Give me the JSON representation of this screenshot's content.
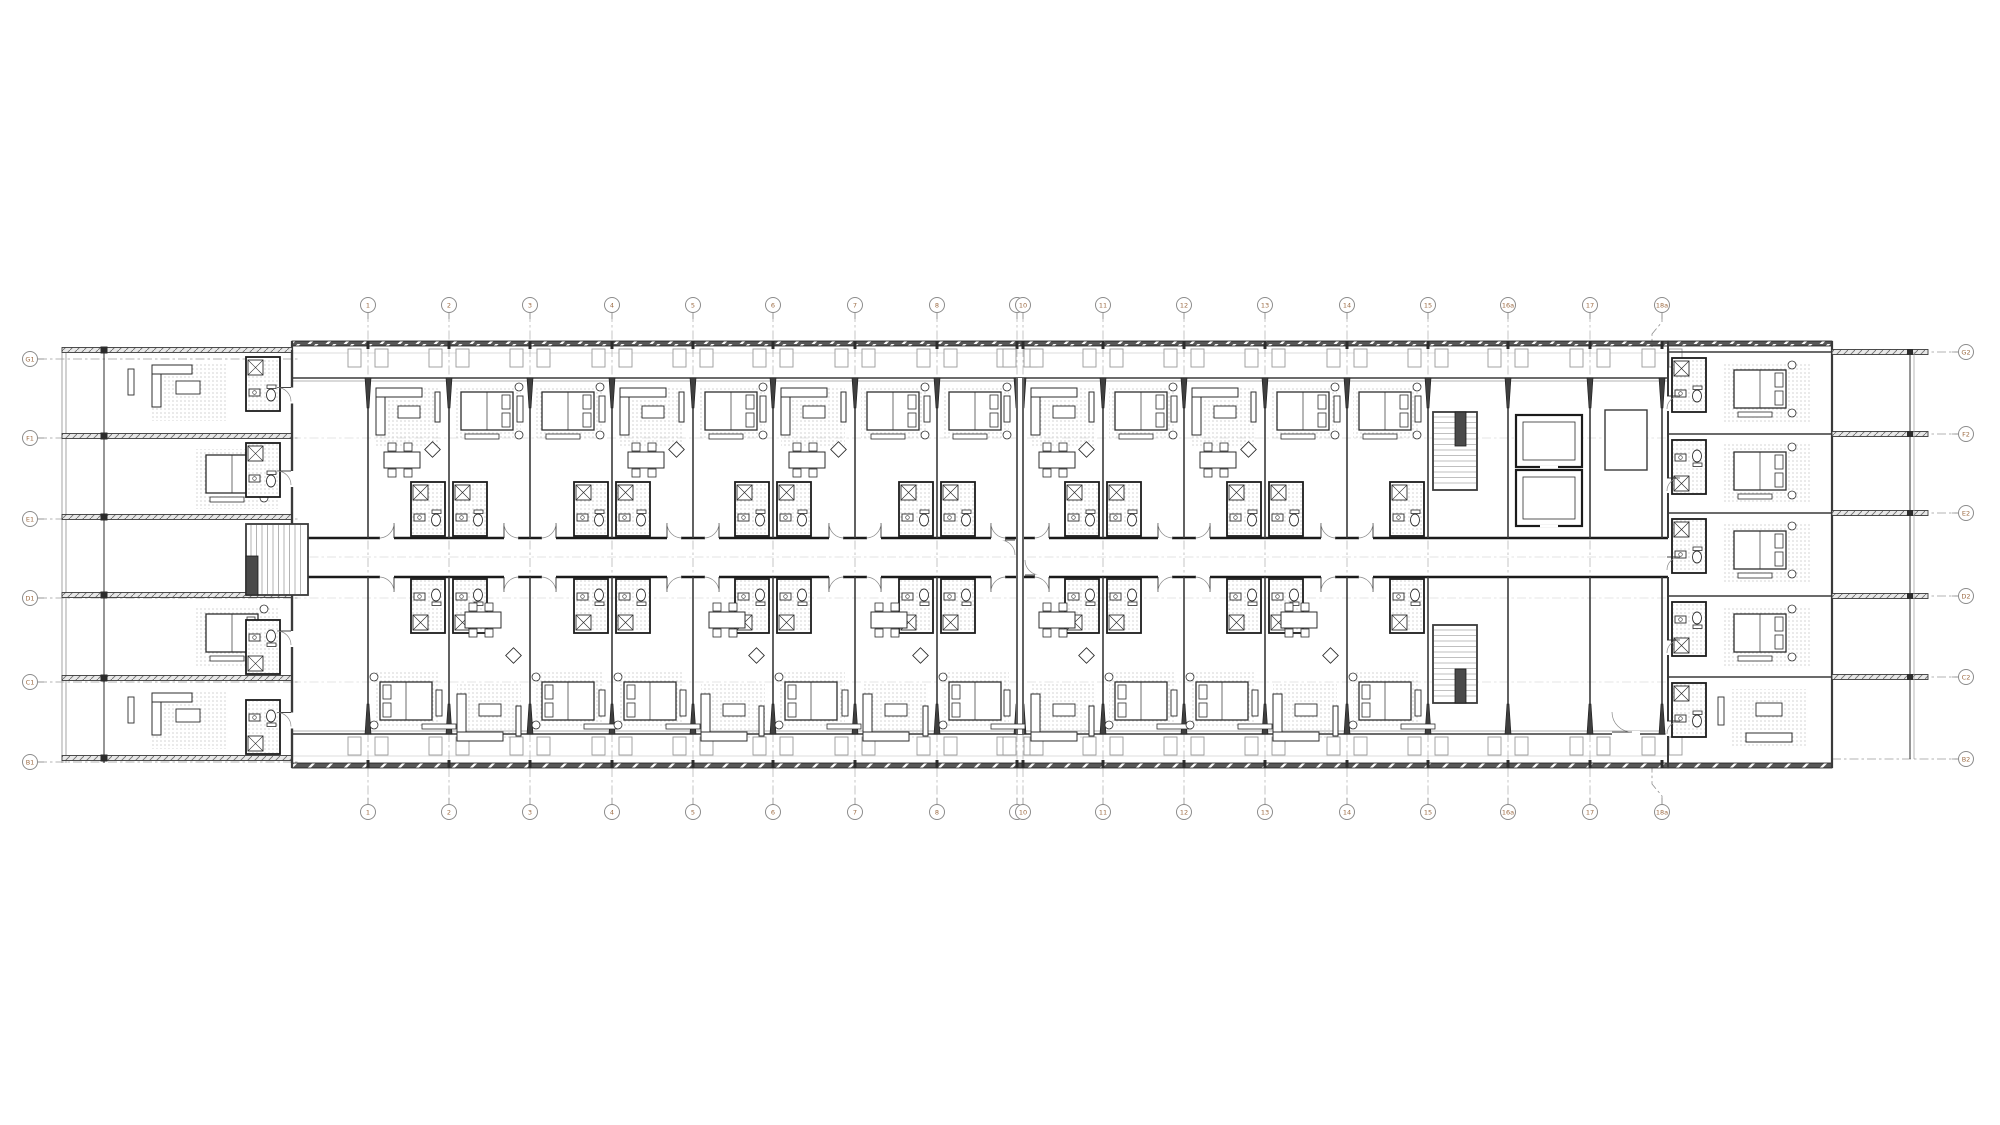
{
  "meta": {
    "drawing_type": "architectural-floor-plan",
    "description": "Typical hotel floor plan: long slab building with central corridor, repeating guestroom modules with bathroom pods, balcony bands top and bottom, west wing with stair, east wing with rooms and terrace fins, stair and elevator core near east end"
  },
  "canvas": {
    "w": 2000,
    "h": 1125,
    "bg": "#ffffff"
  },
  "colors": {
    "line": "#2e2e2e",
    "wall": "#3a3a3a",
    "dark": "#1b1b1b",
    "light": "#9a9a9a",
    "faint": "#bdbdbd",
    "gridline": "#8f8f8f",
    "bubble_stroke": "#8c8c8c",
    "bubble_text": "#9c6b43",
    "stipple": "#9a9a9a",
    "band": "#575757",
    "white": "#ffffff"
  },
  "grid": {
    "top": {
      "y": 305,
      "leader_end": 341,
      "bubbles": [
        {
          "label": "1",
          "x": 368
        },
        {
          "label": "2",
          "x": 449
        },
        {
          "label": "3",
          "x": 530
        },
        {
          "label": "4",
          "x": 612
        },
        {
          "label": "5",
          "x": 693
        },
        {
          "label": "6",
          "x": 773
        },
        {
          "label": "7",
          "x": 855
        },
        {
          "label": "8",
          "x": 937
        },
        {
          "label": "9",
          "x": 1017
        },
        {
          "label": "10",
          "x": 1023
        },
        {
          "label": "11",
          "x": 1103
        },
        {
          "label": "12",
          "x": 1184
        },
        {
          "label": "13",
          "x": 1265
        },
        {
          "label": "14",
          "x": 1347
        },
        {
          "label": "15",
          "x": 1428
        },
        {
          "label": "16a",
          "x": 1508
        },
        {
          "label": "17",
          "x": 1590
        },
        {
          "label": "18a",
          "x": 1662,
          "jog": 14
        }
      ]
    },
    "bottom": {
      "y": 812,
      "leader_end": 768,
      "bubbles": [
        {
          "label": "1",
          "x": 368
        },
        {
          "label": "2",
          "x": 449
        },
        {
          "label": "3",
          "x": 530
        },
        {
          "label": "4",
          "x": 612
        },
        {
          "label": "5",
          "x": 693
        },
        {
          "label": "6",
          "x": 773
        },
        {
          "label": "7",
          "x": 855
        },
        {
          "label": "8",
          "x": 937
        },
        {
          "label": "9",
          "x": 1017
        },
        {
          "label": "10",
          "x": 1023
        },
        {
          "label": "11",
          "x": 1103
        },
        {
          "label": "12",
          "x": 1184
        },
        {
          "label": "13",
          "x": 1265
        },
        {
          "label": "14",
          "x": 1347
        },
        {
          "label": "15",
          "x": 1428
        },
        {
          "label": "16a",
          "x": 1508
        },
        {
          "label": "17",
          "x": 1590
        },
        {
          "label": "18a",
          "x": 1662,
          "jog": 14
        }
      ]
    },
    "left": {
      "x": 30,
      "bubbles": [
        {
          "label": "G1",
          "y": 359
        },
        {
          "label": "F1",
          "y": 438
        },
        {
          "label": "E1",
          "y": 519
        },
        {
          "label": "D1",
          "y": 598
        },
        {
          "label": "C1",
          "y": 682
        },
        {
          "label": "B1",
          "y": 762
        }
      ]
    },
    "right": {
      "x": 1966,
      "bubbles": [
        {
          "label": "G2",
          "y": 352
        },
        {
          "label": "F2",
          "y": 434
        },
        {
          "label": "E2",
          "y": 513
        },
        {
          "label": "D2",
          "y": 596
        },
        {
          "label": "C2",
          "y": 677
        },
        {
          "label": "B2",
          "y": 759
        }
      ]
    }
  },
  "building": {
    "bar": {
      "x1": 292,
      "x2": 1668,
      "top_edge": 341,
      "face_top": 378,
      "pod_top": 482,
      "corr_top": 538,
      "corr_mid": 557,
      "corr_bot": 577,
      "pod_bot_end": 633,
      "face_bot": 734,
      "bot_edge": 763,
      "joint": [
        1017,
        1023
      ]
    },
    "bays_top": [
      {
        "x1": 292,
        "x2": 368,
        "type": "terrace"
      },
      {
        "x1": 368,
        "x2": 449,
        "type": "living"
      },
      {
        "x1": 449,
        "x2": 530,
        "type": "bed"
      },
      {
        "x1": 530,
        "x2": 612,
        "type": "bed"
      },
      {
        "x1": 612,
        "x2": 693,
        "type": "living"
      },
      {
        "x1": 693,
        "x2": 773,
        "type": "bed"
      },
      {
        "x1": 773,
        "x2": 855,
        "type": "living"
      },
      {
        "x1": 855,
        "x2": 937,
        "type": "bed"
      },
      {
        "x1": 937,
        "x2": 1017,
        "type": "bed"
      },
      {
        "x1": 1023,
        "x2": 1103,
        "type": "living"
      },
      {
        "x1": 1103,
        "x2": 1184,
        "type": "bed"
      },
      {
        "x1": 1184,
        "x2": 1265,
        "type": "living"
      },
      {
        "x1": 1265,
        "x2": 1347,
        "type": "bed"
      },
      {
        "x1": 1347,
        "x2": 1428,
        "type": "bed"
      },
      {
        "x1": 1428,
        "x2": 1508,
        "type": "stair"
      },
      {
        "x1": 1508,
        "x2": 1590,
        "type": "elevator"
      },
      {
        "x1": 1590,
        "x2": 1662,
        "type": "lobby"
      }
    ],
    "bays_bottom": [
      {
        "x1": 292,
        "x2": 368,
        "type": "terrace"
      },
      {
        "x1": 368,
        "x2": 449,
        "type": "bed"
      },
      {
        "x1": 449,
        "x2": 530,
        "type": "living"
      },
      {
        "x1": 530,
        "x2": 612,
        "type": "bed"
      },
      {
        "x1": 612,
        "x2": 693,
        "type": "bed"
      },
      {
        "x1": 693,
        "x2": 773,
        "type": "living"
      },
      {
        "x1": 773,
        "x2": 855,
        "type": "bed"
      },
      {
        "x1": 855,
        "x2": 937,
        "type": "living"
      },
      {
        "x1": 937,
        "x2": 1017,
        "type": "bed"
      },
      {
        "x1": 1023,
        "x2": 1103,
        "type": "living"
      },
      {
        "x1": 1103,
        "x2": 1184,
        "type": "bed"
      },
      {
        "x1": 1184,
        "x2": 1265,
        "type": "bed"
      },
      {
        "x1": 1265,
        "x2": 1347,
        "type": "living"
      },
      {
        "x1": 1347,
        "x2": 1428,
        "type": "bed"
      },
      {
        "x1": 1428,
        "x2": 1508,
        "type": "stair"
      },
      {
        "x1": 1508,
        "x2": 1590,
        "type": "lobby"
      },
      {
        "x1": 1590,
        "x2": 1662,
        "type": "lobby"
      }
    ],
    "left_wing": {
      "edge_x1": 62,
      "edge_x2": 66,
      "colonnade_x": 104,
      "room_x1": 110,
      "x2": 292,
      "top": 350,
      "bottom": 763,
      "walls_y": [
        350,
        436,
        517,
        595,
        678,
        758
      ],
      "rooms": [
        {
          "y1": 355,
          "y2": 436,
          "type": "living"
        },
        {
          "y1": 441,
          "y2": 517,
          "type": "bed"
        },
        {
          "y1": 522,
          "y2": 595,
          "type": "stair"
        },
        {
          "y1": 600,
          "y2": 678,
          "type": "bed"
        },
        {
          "y1": 683,
          "y2": 758,
          "type": "living"
        }
      ]
    },
    "right_wing": {
      "x1": 1668,
      "x2": 1832,
      "pod_x": 1672,
      "room_x1": 1712,
      "top": 341,
      "bottom": 763,
      "walls_y": [
        352,
        434,
        513,
        596,
        677
      ],
      "fin_x2": 1928,
      "pergola_x1": 1910,
      "pergola_x2": 1914,
      "rooms": [
        {
          "y1": 352,
          "y2": 434,
          "type": "bed"
        },
        {
          "y1": 434,
          "y2": 513,
          "type": "bed"
        },
        {
          "y1": 513,
          "y2": 596,
          "type": "bed"
        },
        {
          "y1": 596,
          "y2": 677,
          "type": "bed"
        },
        {
          "y1": 677,
          "y2": 759,
          "type": "living"
        }
      ]
    },
    "cores": {
      "stair_top": {
        "x": 1433,
        "y": 412,
        "w": 44,
        "h": 78
      },
      "stair_bottom": {
        "x": 1433,
        "y": 625,
        "w": 44,
        "h": 78
      },
      "elevators": [
        {
          "x": 1516,
          "y": 415,
          "w": 66,
          "h": 52
        },
        {
          "x": 1516,
          "y": 470,
          "w": 66,
          "h": 56
        }
      ],
      "wing_stair": {
        "x": 246,
        "y": 524,
        "w": 62,
        "h": 71
      }
    }
  }
}
